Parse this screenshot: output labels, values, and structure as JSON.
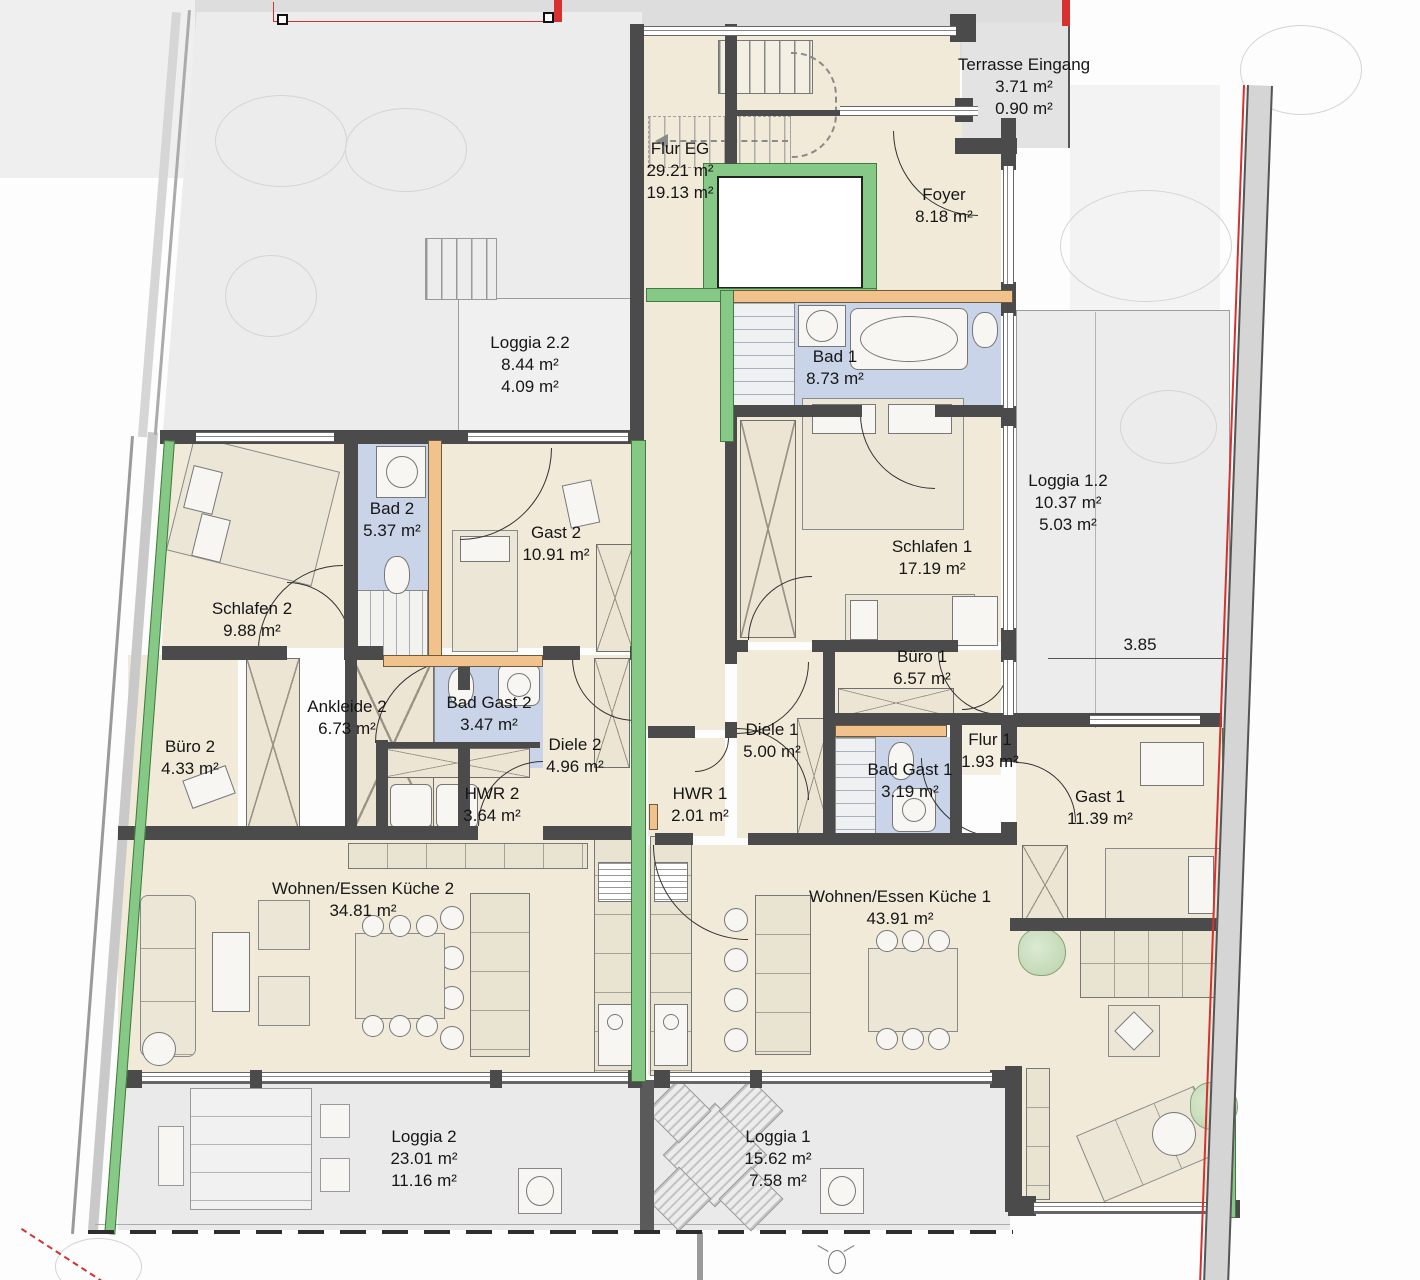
{
  "rooms": {
    "flur_eg": {
      "name": "Flur EG",
      "area": "29.21 m²",
      "area2": "19.13 m²"
    },
    "terrasse_eingang": {
      "name": "Terrasse Eingang",
      "area": "3.71 m²",
      "area2": "0.90 m²"
    },
    "foyer": {
      "name": "Foyer",
      "area": "8.18 m²"
    },
    "loggia_2_2": {
      "name": "Loggia 2.2",
      "area": "8.44 m²",
      "area2": "4.09 m²"
    },
    "bad_1": {
      "name": "Bad 1",
      "area": "8.73 m²"
    },
    "bad_2": {
      "name": "Bad 2",
      "area": "5.37 m²"
    },
    "gast_2": {
      "name": "Gast 2",
      "area": "10.91 m²"
    },
    "loggia_1_2": {
      "name": "Loggia 1.2",
      "area": "10.37 m²",
      "area2": "5.03 m²"
    },
    "schlafen_1": {
      "name": "Schlafen 1",
      "area": "17.19 m²"
    },
    "schlafen_2": {
      "name": "Schlafen 2",
      "area": "9.88 m²"
    },
    "buero_1": {
      "name": "Büro 1",
      "area": "6.57 m²"
    },
    "buero_2": {
      "name": "Büro 2",
      "area": "4.33 m²"
    },
    "ankleide_2": {
      "name": "Ankleide 2",
      "area": "6.73 m²"
    },
    "bad_gast_2": {
      "name": "Bad Gast 2",
      "area": "3.47 m²"
    },
    "diele_2": {
      "name": "Diele 2",
      "area": "4.96 m²"
    },
    "diele_1": {
      "name": "Diele 1",
      "area": "5.00 m²"
    },
    "flur_1": {
      "name": "Flur 1",
      "area": "1.93 m²"
    },
    "bad_gast_1": {
      "name": "Bad Gast 1",
      "area": "3.19 m²"
    },
    "hwr_2": {
      "name": "HWR 2",
      "area": "3.64 m²"
    },
    "hwr_1": {
      "name": "HWR 1",
      "area": "2.01 m²"
    },
    "gast_1": {
      "name": "Gast 1",
      "area": "11.39 m²"
    },
    "wohnen_essen_kueche_2": {
      "name": "Wohnen/Essen Küche 2",
      "area": "34.81 m²"
    },
    "wohnen_essen_kueche_1": {
      "name": "Wohnen/Essen Küche 1",
      "area": "43.91 m²"
    },
    "loggia_2": {
      "name": "Loggia 2",
      "area": "23.01 m²",
      "area2": "11.16 m²"
    },
    "loggia_1": {
      "name": "Loggia 1",
      "area": "15.62 m²",
      "area2": "7.58 m²"
    }
  },
  "annotations": {
    "dimension_385": "3.85"
  },
  "colors": {
    "wall_dark": "#4b4b4b",
    "wall_new_green": "#86c986",
    "wall_wood_orange": "#f2c28d",
    "bath_floor_blue": "#c9d4e8",
    "living_floor_beige": "#f1ead9",
    "loggia_floor_gray": "#ececec",
    "boundary_red": "#d83030"
  }
}
